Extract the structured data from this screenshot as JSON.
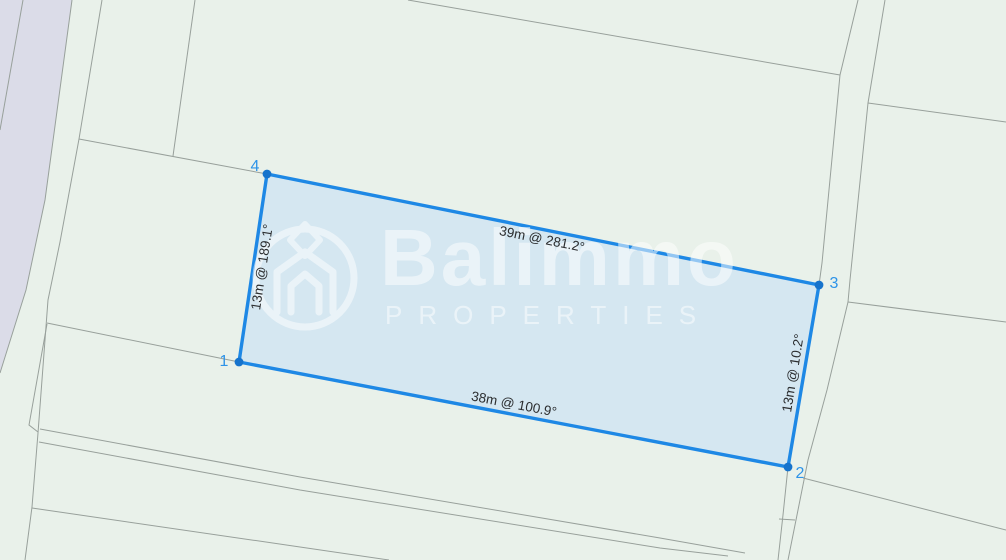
{
  "colors": {
    "background": "#e9f1ea",
    "road_band": "#dbdce8",
    "boundary_line": "#98a09b",
    "parcel_fill": "#cfe4f2",
    "parcel_stroke": "#1e88e5",
    "vertex": "#1673cc",
    "corner_text": "#2d93e8",
    "edge_text": "#2b2d2f",
    "watermark": "#ffffff"
  },
  "road_polygon": [
    [
      0,
      0
    ],
    [
      72,
      0
    ],
    [
      45,
      200
    ],
    [
      26,
      290
    ],
    [
      0,
      373
    ]
  ],
  "boundaries": [
    [
      [
        23,
        0
      ],
      [
        0,
        130
      ]
    ],
    [
      [
        72,
        0
      ],
      [
        45,
        200
      ],
      [
        26,
        290
      ],
      [
        0,
        373
      ]
    ],
    [
      [
        102,
        0
      ],
      [
        79,
        139
      ],
      [
        60,
        242
      ],
      [
        48,
        300
      ],
      [
        38,
        433
      ],
      [
        32,
        507
      ],
      [
        25,
        560
      ]
    ],
    [
      [
        47,
        324
      ],
      [
        29,
        425
      ],
      [
        38,
        432
      ]
    ],
    [
      [
        47,
        323
      ],
      [
        239,
        362
      ]
    ],
    [
      [
        79,
        139
      ],
      [
        267,
        174
      ]
    ],
    [
      [
        195,
        0
      ],
      [
        173,
        156
      ]
    ],
    [
      [
        408,
        0
      ],
      [
        840,
        75
      ]
    ],
    [
      [
        858,
        0
      ],
      [
        840,
        75
      ],
      [
        822,
        263
      ],
      [
        819,
        285
      ],
      [
        788,
        467
      ],
      [
        783,
        515
      ],
      [
        778,
        560
      ]
    ],
    [
      [
        885,
        0
      ],
      [
        868,
        103
      ],
      [
        850,
        280
      ],
      [
        848,
        302
      ],
      [
        827,
        390
      ],
      [
        808,
        460
      ],
      [
        795,
        525
      ],
      [
        788,
        560
      ]
    ],
    [
      [
        868,
        103
      ],
      [
        1006,
        122
      ]
    ],
    [
      [
        848,
        302
      ],
      [
        1006,
        322
      ]
    ],
    [
      [
        803,
        478
      ],
      [
        1006,
        530
      ]
    ],
    [
      [
        779,
        519
      ],
      [
        795,
        520
      ]
    ],
    [
      [
        40,
        429
      ],
      [
        300,
        477
      ],
      [
        660,
        538
      ],
      [
        745,
        553
      ]
    ],
    [
      [
        39,
        442
      ],
      [
        300,
        490
      ],
      [
        660,
        548
      ],
      [
        728,
        556
      ]
    ],
    [
      [
        32,
        508
      ],
      [
        300,
        547
      ],
      [
        389,
        560
      ]
    ]
  ],
  "parcel": {
    "polygon": [
      [
        239,
        362
      ],
      [
        267,
        174
      ],
      [
        819,
        285
      ],
      [
        788,
        467
      ]
    ],
    "corners": [
      {
        "n": "1",
        "x": 224,
        "y": 362
      },
      {
        "n": "2",
        "x": 800,
        "y": 474
      },
      {
        "n": "3",
        "x": 834,
        "y": 284
      },
      {
        "n": "4",
        "x": 255,
        "y": 167
      }
    ],
    "vertices": [
      {
        "x": 239,
        "y": 362
      },
      {
        "x": 788,
        "y": 467
      },
      {
        "x": 819,
        "y": 285
      },
      {
        "x": 267,
        "y": 174
      }
    ],
    "edges": [
      {
        "label": "39m @ 281.2°",
        "x": 542,
        "y": 239,
        "angle": 11.3
      },
      {
        "label": "13m @ 10.2°",
        "x": 793,
        "y": 373,
        "angle": -80.6
      },
      {
        "label": "38m @ 100.9°",
        "x": 514,
        "y": 404,
        "angle": 10.9
      },
      {
        "label": "13m @ 189.1°",
        "x": 262,
        "y": 267,
        "angle": -81.5
      }
    ]
  },
  "watermark": {
    "brand": "Balimmo",
    "subtitle": "PROPERTIES"
  }
}
